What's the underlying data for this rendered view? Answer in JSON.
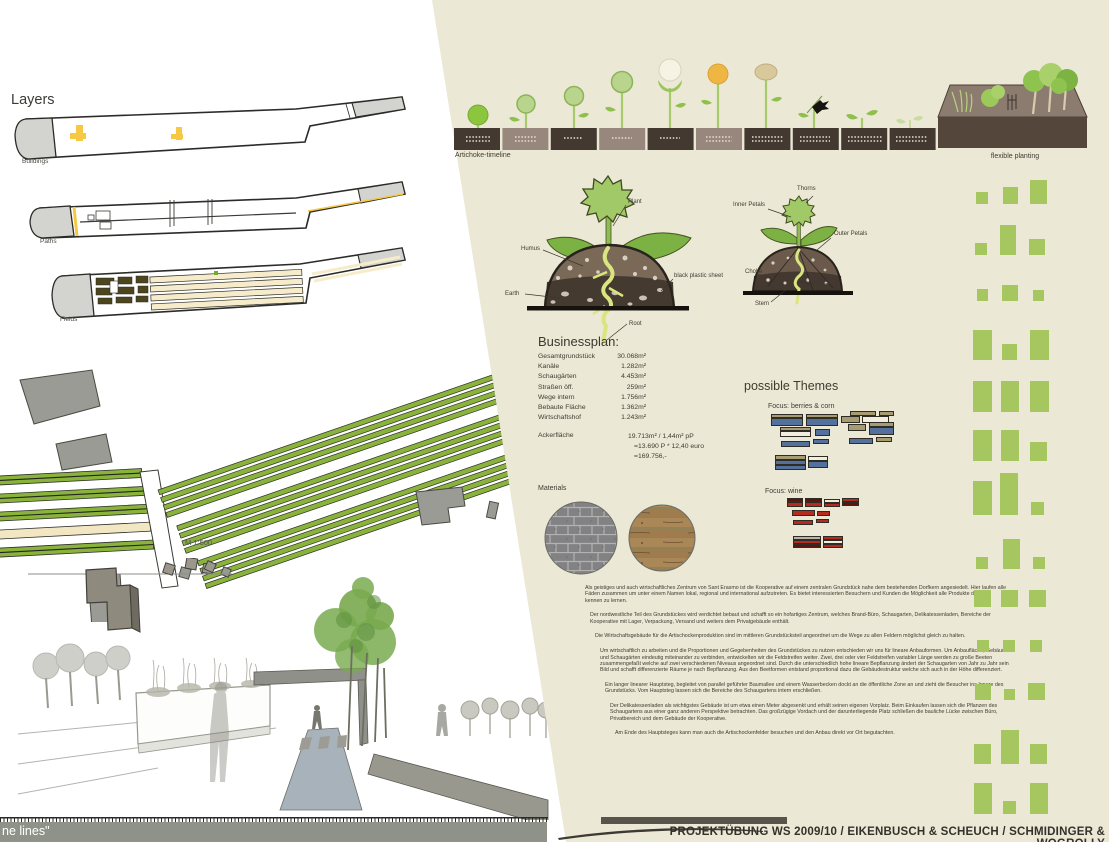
{
  "colors": {
    "beige_panel": "#ece8d6",
    "field_green": "#a6c65f",
    "soil_dark": "#443931",
    "soil_taupe": "#97877c",
    "accent_yellow": "#f6c844",
    "bars": {
      "blue": "#54719d",
      "tan": "#a59c73",
      "cream": "#f2eedd",
      "red": "#b62b1e",
      "darkred": "#5f130c",
      "gray": "#b9b4a6"
    }
  },
  "layers_panel": {
    "title": "Layers",
    "items": [
      {
        "label": "Buildings"
      },
      {
        "label": "Paths"
      },
      {
        "label": "Fields"
      }
    ]
  },
  "site_plan": {
    "scale_label": "M 1:500"
  },
  "timeline": {
    "label": "Artichoke-timeline"
  },
  "flexible_planting": {
    "label": "flexible planting"
  },
  "plant_section_diagram": {
    "labels": {
      "plant": "Plant",
      "humus": "Humus",
      "earth": "Earth",
      "sheet": "black plastic sheet",
      "root": "Root"
    }
  },
  "artichoke_anatomy": {
    "labels": {
      "thorns": "Thorns",
      "inner_petals": "Inner Petals",
      "outer_petals": "Outer Petals",
      "choke": "Choke",
      "heart": "Heart",
      "stem": "Stem"
    }
  },
  "businessplan": {
    "title": "Businessplan:",
    "rows": [
      {
        "label": "Gesamtgrundstück",
        "value": "30.068m²"
      },
      {
        "label": "Kanäle",
        "value": "1.282m²"
      },
      {
        "label": "Schaugärten",
        "value": "4.453m²"
      },
      {
        "label": "Straßen öff.",
        "value": "259m²"
      },
      {
        "label": "Wege intern",
        "value": "1.756m²"
      },
      {
        "label": "Bebaute Fläche",
        "value": "1.362m²"
      },
      {
        "label": "Wirtschaftshof",
        "value": "1.243m²"
      }
    ],
    "acker": {
      "label": "Ackerfläche",
      "lines": [
        "19.713m² / 1,44m² pP",
        "=13.690 P * 12,40 euro",
        "=169.756,-"
      ]
    }
  },
  "themes": {
    "title": "possible Themes",
    "focus_berries": "Focus:  berries & corn",
    "focus_wine": "Focus:  wine",
    "berries_bars": [
      [
        771,
        414,
        32,
        4,
        "tan"
      ],
      [
        771,
        418,
        32,
        8,
        "blue"
      ],
      [
        806,
        414,
        32,
        4,
        "tan"
      ],
      [
        806,
        418,
        32,
        8,
        "blue"
      ],
      [
        841,
        416,
        19,
        7,
        "tan"
      ],
      [
        862,
        416,
        27,
        7,
        "cream"
      ],
      [
        780,
        427,
        31,
        4,
        "tan"
      ],
      [
        780,
        431,
        31,
        6,
        "cream"
      ],
      [
        815,
        429,
        15,
        7,
        "blue"
      ],
      [
        781,
        441,
        29,
        6,
        "blue"
      ],
      [
        813,
        439,
        16,
        5,
        "blue"
      ],
      [
        775,
        455,
        31,
        5,
        "tan"
      ],
      [
        775,
        460,
        31,
        5,
        "blue"
      ],
      [
        775,
        465,
        31,
        5,
        "blue"
      ],
      [
        808,
        456,
        20,
        5,
        "cream"
      ],
      [
        808,
        461,
        20,
        7,
        "blue"
      ],
      [
        850,
        411,
        26,
        5,
        "tan"
      ],
      [
        879,
        411,
        15,
        5,
        "tan"
      ],
      [
        848,
        424,
        18,
        7,
        "tan"
      ],
      [
        869,
        422,
        25,
        5,
        "tan"
      ],
      [
        869,
        427,
        25,
        8,
        "blue"
      ],
      [
        849,
        438,
        24,
        6,
        "blue"
      ],
      [
        876,
        437,
        16,
        5,
        "tan"
      ]
    ],
    "wine_bars": [
      [
        787,
        498,
        16,
        4,
        "darkred"
      ],
      [
        787,
        502,
        16,
        5,
        "red"
      ],
      [
        805,
        498,
        17,
        4,
        "darkred"
      ],
      [
        805,
        502,
        17,
        5,
        "red"
      ],
      [
        824,
        499,
        16,
        4,
        "cream"
      ],
      [
        824,
        503,
        16,
        4,
        "red"
      ],
      [
        842,
        498,
        17,
        4,
        "red"
      ],
      [
        842,
        502,
        17,
        4,
        "darkred"
      ],
      [
        792,
        510,
        23,
        6,
        "red"
      ],
      [
        817,
        511,
        13,
        5,
        "red"
      ],
      [
        793,
        520,
        20,
        5,
        "red"
      ],
      [
        816,
        519,
        13,
        4,
        "red"
      ],
      [
        793,
        536,
        28,
        4,
        "gray"
      ],
      [
        793,
        540,
        28,
        4,
        "red"
      ],
      [
        793,
        544,
        28,
        4,
        "darkred"
      ],
      [
        823,
        536,
        20,
        4,
        "red"
      ],
      [
        823,
        540,
        20,
        4,
        "cream"
      ],
      [
        823,
        544,
        20,
        4,
        "red"
      ]
    ]
  },
  "materials": {
    "label": "Materials"
  },
  "field_pattern": {
    "rows": [
      {
        "b": 204,
        "cells": [
          [
            976,
            12,
            12
          ],
          [
            1003,
            15,
            17
          ],
          [
            1030,
            17,
            24
          ]
        ]
      },
      {
        "b": 255,
        "cells": [
          [
            975,
            12,
            12
          ],
          [
            1000,
            16,
            30
          ],
          [
            1029,
            16,
            16
          ]
        ]
      },
      {
        "b": 301,
        "cells": [
          [
            977,
            11,
            12
          ],
          [
            1002,
            16,
            16
          ],
          [
            1033,
            11,
            11
          ]
        ]
      },
      {
        "b": 360,
        "cells": [
          [
            973,
            19,
            30
          ],
          [
            1002,
            15,
            16
          ],
          [
            1030,
            19,
            30
          ]
        ]
      },
      {
        "b": 412,
        "cells": [
          [
            973,
            19,
            31
          ],
          [
            1001,
            18,
            31
          ],
          [
            1030,
            19,
            31
          ]
        ]
      },
      {
        "b": 461,
        "cells": [
          [
            973,
            19,
            31
          ],
          [
            1001,
            18,
            31
          ],
          [
            1030,
            17,
            19
          ]
        ]
      },
      {
        "b": 515,
        "cells": [
          [
            973,
            19,
            34
          ],
          [
            1000,
            18,
            42
          ],
          [
            1031,
            13,
            13
          ]
        ]
      },
      {
        "b": 569,
        "cells": [
          [
            976,
            12,
            12
          ],
          [
            1003,
            17,
            30
          ],
          [
            1033,
            12,
            12
          ]
        ]
      },
      {
        "b": 607,
        "cells": [
          [
            974,
            17,
            17
          ],
          [
            1001,
            17,
            17
          ],
          [
            1029,
            17,
            17
          ]
        ]
      },
      {
        "b": 652,
        "cells": [
          [
            977,
            12,
            12
          ],
          [
            1003,
            12,
            12
          ],
          [
            1030,
            12,
            12
          ]
        ]
      },
      {
        "b": 700,
        "cells": [
          [
            975,
            16,
            16
          ],
          [
            1004,
            11,
            11
          ],
          [
            1028,
            17,
            17
          ]
        ]
      },
      {
        "b": 764,
        "cells": [
          [
            974,
            17,
            20
          ],
          [
            1001,
            18,
            34
          ],
          [
            1030,
            17,
            20
          ]
        ]
      },
      {
        "b": 814,
        "cells": [
          [
            974,
            18,
            31
          ],
          [
            1003,
            13,
            13
          ],
          [
            1030,
            18,
            31
          ]
        ]
      }
    ]
  },
  "description_paragraphs": [
    "Als geistiges und auch wirtschaftliches Zentrum von Sant Erasmo ist die Kooperative auf einem zentralen Grundstück nahe dem bestehenden Dorfkern angesiedelt. Hier laufen alle Fäden zusammen um unter einem Namen lokal, regional und international aufzutreten. Es bietet interessierten Besuchern und Kunden die Möglichkeit alle Produkte der Insel kennen zu lernen.",
    "Der nordwestliche Teil des Grundstückes wird verdichtet bebaut und schafft so ein hofartiges Zentrum, welches Brand-Büro, Schaugarten, Delikatessenladen, Bereiche der Kooperative mit Lager, Verpackung, Versand und weiters dem Privatgebäude enthält.",
    "Die Wirtschaftsgebäude für die Artischockenproduktion sind im mittleren Grundstücksteil angeordnet um die Wege zu allen Feldern möglichst gleich zu halten.",
    "Um wirtschaftlich zu arbeiten und die Proportionen und Gegebenheiten des Grundstückes zu nutzen entschieden wir uns für lineare Anbauformen. Um Anbaufläche, Gebäude und Schaugärten eindeutig miteinander zu verbinden, entwickelten wir die Feldstreifen weiter. Zwei, drei oder vier Feldstreifen variabler Länge werden zu große Beeten zusammengefaßt welche auf zwei verschiedenen Niveaus angeordnet sind. Durch die unterschiedlich hohe lineare Bepflanzung ändert der Schaugarten von Jahr zu Jahr sein Bild und schafft differenzierte Räume je nach Bepflanzung. Aus den Beetformen entstand proportional dazu die Gebäudestruktur welche sich auch in der Höhe differenziert.",
    "Ein langer linearer Hauptsteg, begleitet von parallel geführter Baumallee und einem Wasserbecken dockt an die öffentliche Zone an und zieht die Besucher ins Innere des Grundstücks. Vom Hauptsteg lassen sich die Bereiche des Schaugartens intern erschließen.",
    "Der Delikatessenladen als wichtigstes Gebäude ist um etwa einen Meter abgesenkt und erhält seinen eigenen Vorplatz. Beim Einkaufen lassen sich die Pflanzen des Schaugartens aus einer ganz anderen Perspektive betrachten. Das großzügige Vordach und der darunterliegende Platz schließen die bauliche Lücke zwischen Büro, Privatbereich und dem Gebäude der Kooperative.",
    "Am Ende des Hauptsteges kann man auch die Artischockenfelder besuchen und den Anbau direkt vor Ort begutachten."
  ],
  "footer": {
    "left_text": "ne lines\"",
    "right_text": "PROJEKTÜBUNG WS 2009/10 / EIKENBUSCH & SCHEUCH /  SCHMIDINGER & WOGROLLY"
  }
}
